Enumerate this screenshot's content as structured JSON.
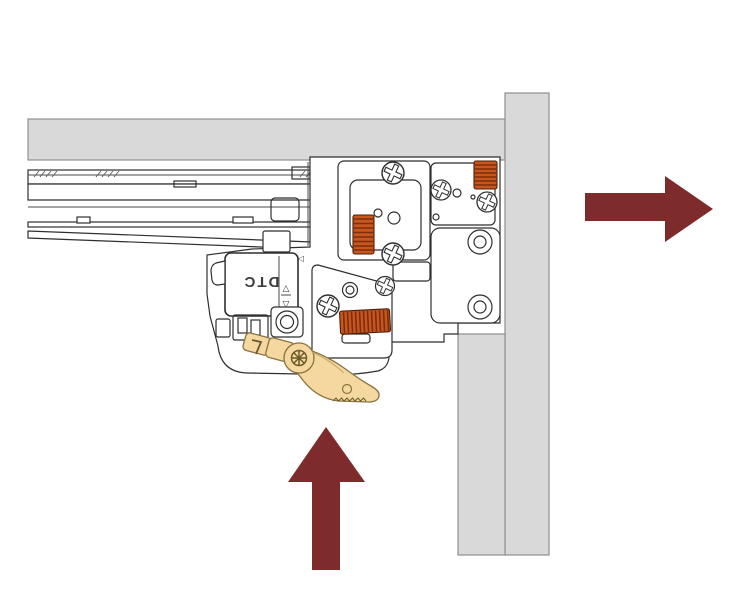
{
  "figure": {
    "type": "technical-illustration",
    "subject": "drawer-slide rear locking mechanism at cabinet panel",
    "brand_label": "DTC",
    "indicator_glyphs": {
      "up": "△",
      "down": "▽",
      "left": "◁"
    },
    "arrows": [
      {
        "id": "arrow-right",
        "direction": "right"
      },
      {
        "id": "arrow-up",
        "direction": "up"
      }
    ],
    "colors": {
      "background": "#FFFFFF",
      "panel_fill": "#D9D9D9",
      "panel_stroke": "#8F8F8F",
      "outline": "#2E2E2E",
      "gear_fill": "#C8571D",
      "gear_rib": "#7C2D0B",
      "lever_fill": "#F5D7A0",
      "lever_stroke": "#8A7340",
      "arrow_fill": "#7D2B2B",
      "label_color": "#3D3D3D"
    }
  }
}
